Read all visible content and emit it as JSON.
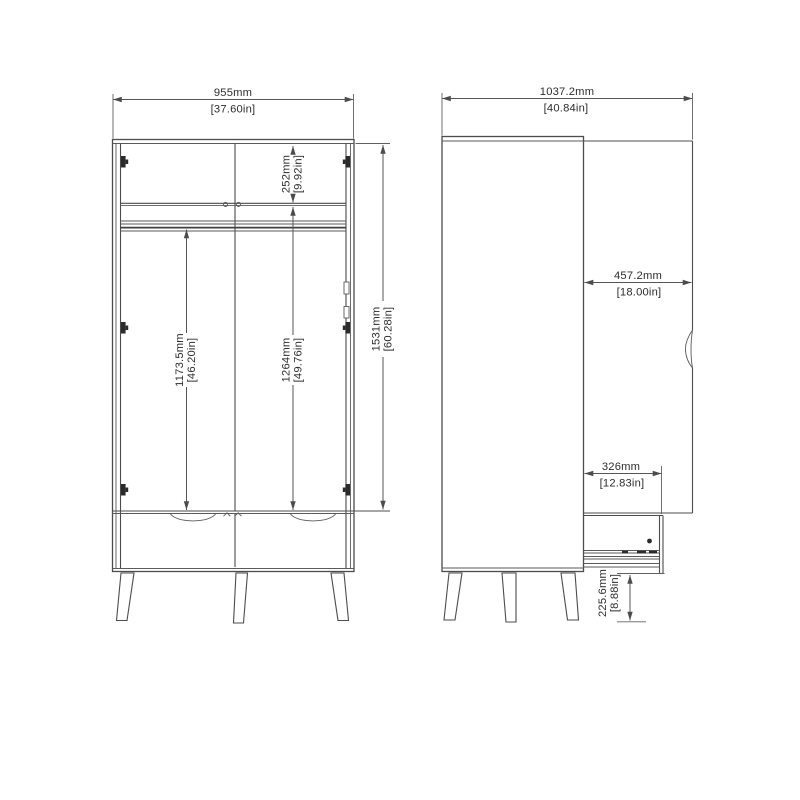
{
  "drawing": {
    "front_view": {
      "width": {
        "mm": "955mm",
        "inch": "[37.60in]"
      },
      "top_compartment_height": {
        "mm": "252mm",
        "inch": "[9.92in]"
      },
      "interior_height_left": {
        "mm": "1173.5mm",
        "inch": "[46.20in]"
      },
      "interior_height_right": {
        "mm": "1264mm",
        "inch": "[49.76in]"
      },
      "door_section_height": {
        "mm": "1531mm",
        "inch": "[60.28in]"
      }
    },
    "side_view": {
      "overall_depth_door_open": {
        "mm": "1037.2mm",
        "inch": "[40.84in]"
      },
      "door_width": {
        "mm": "457.2mm",
        "inch": "[18.00in]"
      },
      "drawer_extension": {
        "mm": "326mm",
        "inch": "[12.83in]"
      },
      "underside_clearance": {
        "mm": "225.6mm",
        "inch": "[8.88in]"
      }
    },
    "colors": {
      "line": "#4c4c4c",
      "text": "#2d2d2d",
      "background": "#ffffff",
      "hinge_fill": "#2b2b2b"
    }
  }
}
